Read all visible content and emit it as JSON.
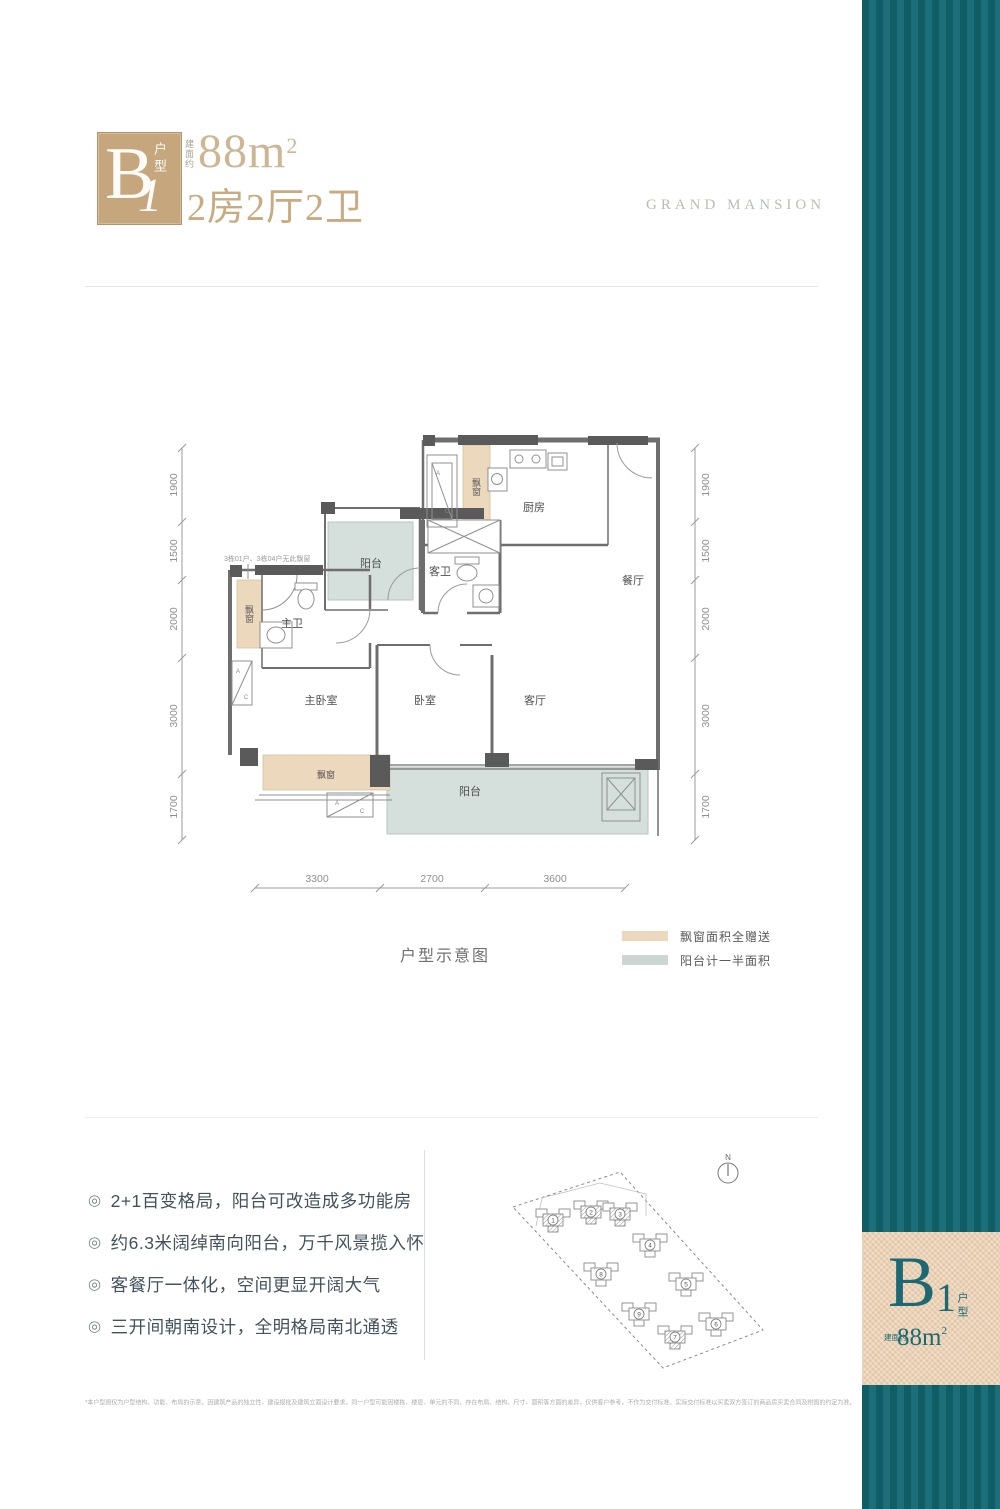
{
  "colors": {
    "accent_tan": "#c6a67c",
    "accent_teal": "#17656e",
    "bay_fill": "#ecd9bd",
    "balcony_fill": "#d5dfdc"
  },
  "header": {
    "badge_letter": "B",
    "badge_number": "1",
    "badge_label": "户型",
    "area_prefix": "建面约",
    "area_value": "88m",
    "area_sup": "2",
    "layout_text": "2房2厅2卫",
    "brand": "GRAND MANSION"
  },
  "plan": {
    "note": "3栋01户、3栋04户无此飘窗",
    "caption": "户型示意图",
    "ac_a": "A",
    "ac_c": "C",
    "rooms": {
      "kitchen": "厨房",
      "guest_bath": "客卫",
      "dining": "餐厅",
      "master_bath": "主卫",
      "master_bedroom": "主卧室",
      "bedroom": "卧室",
      "living": "客厅",
      "balcony_top": "阳台",
      "balcony_bottom": "阳台",
      "bay_top": "飘窗",
      "bay_left": "飘窗",
      "bay_bottom": "飘窗"
    },
    "dims_left": [
      "1900",
      "1500",
      "2000",
      "3000",
      "1700"
    ],
    "dims_right": [
      "1900",
      "1500",
      "2000",
      "3000",
      "1700"
    ],
    "dims_bottom": [
      "3300",
      "2700",
      "3600"
    ],
    "legend": [
      {
        "label": "飘窗面积全赠送",
        "color": "#ecd9bd"
      },
      {
        "label": "阳台计一半面积",
        "color": "#ccd7d4"
      }
    ]
  },
  "features": {
    "bullet_icon": "◎",
    "items": [
      "2+1百变格局，阳台可改造成多功能房",
      "约6.3米阔绰南向阳台，万千风景揽入怀",
      "客餐厅一体化，空间更显开阔大气",
      "三开间朝南设计，全明格局南北通透"
    ]
  },
  "site": {
    "north": "N",
    "buildings": [
      {
        "num": "1"
      },
      {
        "num": "2"
      },
      {
        "num": "3"
      },
      {
        "num": "4"
      },
      {
        "num": "8"
      },
      {
        "num": "5"
      },
      {
        "num": "9"
      },
      {
        "num": "7"
      },
      {
        "num": "6"
      }
    ]
  },
  "sidebar": {
    "badge_letter": "B",
    "badge_number": "1",
    "badge_label": "户型",
    "area_prefix": "建面约",
    "area_value": "88m",
    "area_sup": "2"
  },
  "footer": {
    "disclaimer": "*本户型图仅为户型结构、功能、布局的示意。因建筑产品的独立性、建设报批及建筑立面设计要求，同一户型可能因楼栋、楼层、单元的不同，存在布局、结构、尺寸、面积等方面的差异，仅供客户参考，不作为交付标准。实际交付标准以买卖双方签订的商品房买卖合同及附图的约定为准。"
  }
}
